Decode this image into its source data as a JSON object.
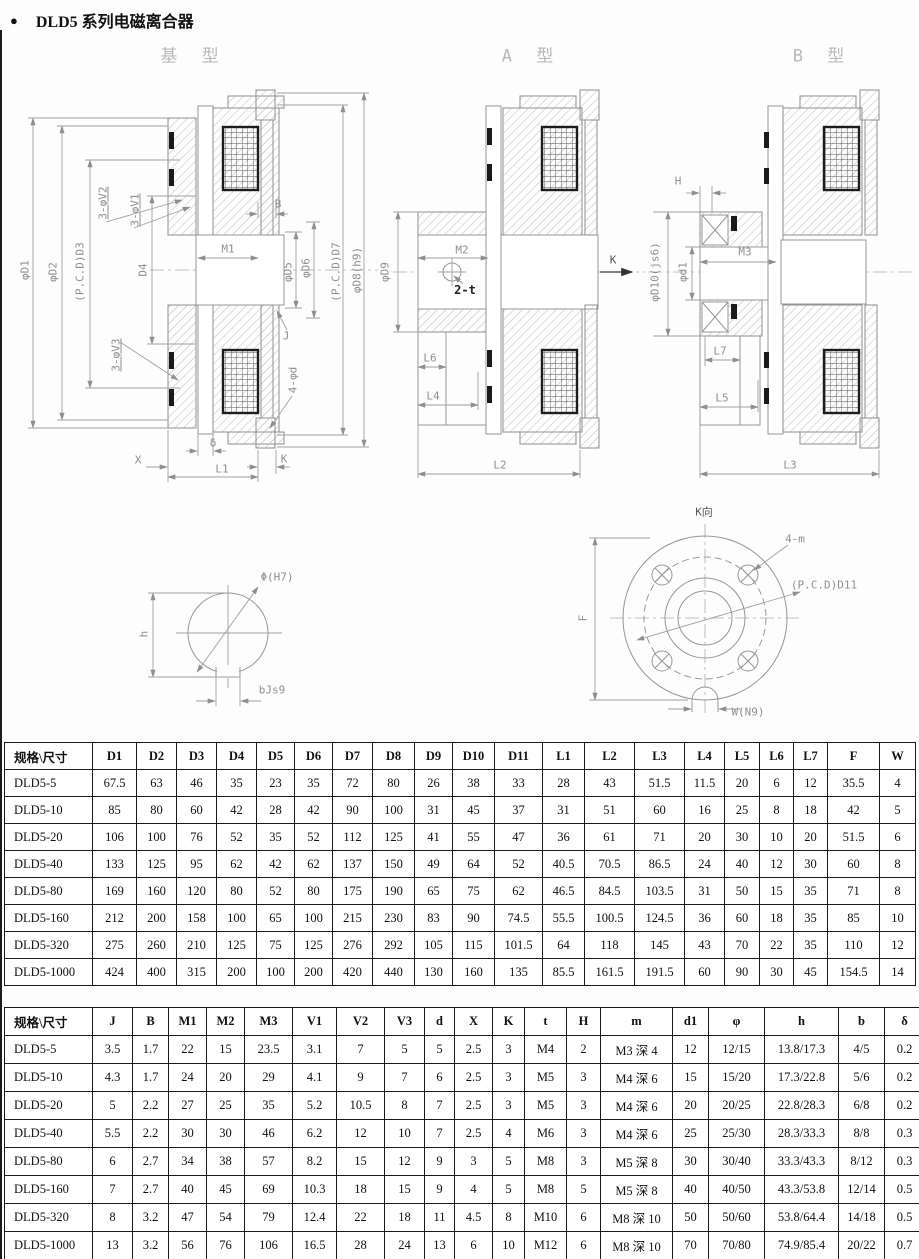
{
  "page": {
    "bullet": "●",
    "title": "DLD5 系列电磁离合器"
  },
  "drawings": {
    "labels": [
      {
        "n": "base-type-title",
        "t": "基 型",
        "x": 193,
        "y": 57,
        "cls": "title"
      },
      {
        "n": "a-type-title",
        "t": "A 型",
        "x": 531,
        "y": 57,
        "cls": "title"
      },
      {
        "n": "b-type-title",
        "t": "B 型",
        "x": 822,
        "y": 57,
        "cls": "title"
      },
      {
        "n": "dim-phi-d1",
        "t": "φD1",
        "x": 25,
        "y": 270,
        "r": -90
      },
      {
        "n": "dim-phi-d2",
        "t": "φD2",
        "x": 53,
        "y": 272,
        "r": -90
      },
      {
        "n": "dim-pcd-d3",
        "t": "(P.C.D)D3",
        "x": 80,
        "y": 272,
        "r": -90
      },
      {
        "n": "dim-3-phi-v2",
        "t": "3-φV2",
        "x": 103,
        "y": 203,
        "r": -90,
        "cls": "und"
      },
      {
        "n": "dim-3-phi-v1",
        "t": "3-φV1",
        "x": 135,
        "y": 210,
        "r": -90,
        "cls": "und"
      },
      {
        "n": "dim-d4",
        "t": "D4",
        "x": 143,
        "y": 270,
        "r": -90
      },
      {
        "n": "dim-3-phi-v3",
        "t": "3-φV3",
        "x": 116,
        "y": 355,
        "r": -90,
        "cls": "und"
      },
      {
        "n": "dim-m1",
        "t": "M1",
        "x": 228,
        "y": 249
      },
      {
        "n": "dim-b",
        "t": "B",
        "x": 278,
        "y": 204
      },
      {
        "n": "dim-phi-d5",
        "t": "φD5",
        "x": 288,
        "y": 272,
        "r": -90
      },
      {
        "n": "dim-phi-d6",
        "t": "φD6",
        "x": 306,
        "y": 268,
        "r": -90
      },
      {
        "n": "dim-pcd-d7",
        "t": "(P.C.D)D7",
        "x": 336,
        "y": 272,
        "r": -90
      },
      {
        "n": "dim-phi-d8",
        "t": "φD8(h9)",
        "x": 357,
        "y": 270,
        "r": -90
      },
      {
        "n": "dim-j",
        "t": "J",
        "x": 286,
        "y": 336
      },
      {
        "n": "dim-4-phi-d",
        "t": "4-φd",
        "x": 293,
        "y": 380,
        "r": -90
      },
      {
        "n": "dim-delta",
        "t": "δ",
        "x": 213,
        "y": 443
      },
      {
        "n": "dim-x",
        "t": "X",
        "x": 138,
        "y": 460
      },
      {
        "n": "dim-l1",
        "t": "L1",
        "x": 222,
        "y": 469
      },
      {
        "n": "dim-k1",
        "t": "K",
        "x": 284,
        "y": 459
      },
      {
        "n": "dim-phi-d9",
        "t": "φD9",
        "x": 385,
        "y": 272,
        "r": -90
      },
      {
        "n": "dim-m2",
        "t": "M2",
        "x": 462,
        "y": 250
      },
      {
        "n": "dim-2-t",
        "t": "2-t",
        "x": 465,
        "y": 290,
        "cls": "dark"
      },
      {
        "n": "dim-l6",
        "t": "L6",
        "x": 430,
        "y": 358
      },
      {
        "n": "dim-l4",
        "t": "L4",
        "x": 433,
        "y": 396
      },
      {
        "n": "dim-l2",
        "t": "L2",
        "x": 500,
        "y": 465
      },
      {
        "n": "dim-k2",
        "t": "K",
        "x": 613,
        "y": 260,
        "cls": "semi"
      },
      {
        "n": "dim-h-gap",
        "t": "H",
        "x": 678,
        "y": 181
      },
      {
        "n": "dim-phi-d10",
        "t": "φD10(js6)",
        "x": 655,
        "y": 272,
        "r": -90
      },
      {
        "n": "dim-phi-d1-small",
        "t": "φd1",
        "x": 683,
        "y": 272,
        "r": -90
      },
      {
        "n": "dim-m3",
        "t": "M3",
        "x": 745,
        "y": 252
      },
      {
        "n": "dim-l7",
        "t": "L7",
        "x": 720,
        "y": 351
      },
      {
        "n": "dim-l5",
        "t": "L5",
        "x": 722,
        "y": 398
      },
      {
        "n": "dim-l3",
        "t": "L3",
        "x": 790,
        "y": 465
      },
      {
        "n": "dim-phi-h7",
        "t": "Φ(H7)",
        "x": 277,
        "y": 577
      },
      {
        "n": "dim-h-bore",
        "t": "h",
        "x": 144,
        "y": 634,
        "r": -90
      },
      {
        "n": "dim-b-js9",
        "t": "bJs9",
        "x": 272,
        "y": 690
      },
      {
        "n": "k-view-title",
        "t": "K向",
        "x": 704,
        "y": 512,
        "cls": "semi"
      },
      {
        "n": "dim-4-m",
        "t": "4-m",
        "x": 795,
        "y": 539
      },
      {
        "n": "dim-pcd-d11",
        "t": "(P.C.D)D11",
        "x": 824,
        "y": 585
      },
      {
        "n": "dim-f",
        "t": "F",
        "x": 583,
        "y": 618,
        "r": -90
      },
      {
        "n": "dim-w-n9",
        "t": "W(N9)",
        "x": 748,
        "y": 712
      }
    ]
  },
  "tables": [
    {
      "name": "dimensions-table-1",
      "headers": [
        "规格\\尺寸",
        "D1",
        "D2",
        "D3",
        "D4",
        "D5",
        "D6",
        "D7",
        "D8",
        "D9",
        "D10",
        "D11",
        "L1",
        "L2",
        "L3",
        "L4",
        "L5",
        "L6",
        "L7",
        "F",
        "W"
      ],
      "rows": [
        [
          "DLD5-5",
          "67.5",
          "63",
          "46",
          "35",
          "23",
          "35",
          "72",
          "80",
          "26",
          "38",
          "33",
          "28",
          "43",
          "51.5",
          "11.5",
          "20",
          "6",
          "12",
          "35.5",
          "4"
        ],
        [
          "DLD5-10",
          "85",
          "80",
          "60",
          "42",
          "28",
          "42",
          "90",
          "100",
          "31",
          "45",
          "37",
          "31",
          "51",
          "60",
          "16",
          "25",
          "8",
          "18",
          "42",
          "5"
        ],
        [
          "DLD5-20",
          "106",
          "100",
          "76",
          "52",
          "35",
          "52",
          "112",
          "125",
          "41",
          "55",
          "47",
          "36",
          "61",
          "71",
          "20",
          "30",
          "10",
          "20",
          "51.5",
          "6"
        ],
        [
          "DLD5-40",
          "133",
          "125",
          "95",
          "62",
          "42",
          "62",
          "137",
          "150",
          "49",
          "64",
          "52",
          "40.5",
          "70.5",
          "86.5",
          "24",
          "40",
          "12",
          "30",
          "60",
          "8"
        ],
        [
          "DLD5-80",
          "169",
          "160",
          "120",
          "80",
          "52",
          "80",
          "175",
          "190",
          "65",
          "75",
          "62",
          "46.5",
          "84.5",
          "103.5",
          "31",
          "50",
          "15",
          "35",
          "71",
          "8"
        ],
        [
          "DLD5-160",
          "212",
          "200",
          "158",
          "100",
          "65",
          "100",
          "215",
          "230",
          "83",
          "90",
          "74.5",
          "55.5",
          "100.5",
          "124.5",
          "36",
          "60",
          "18",
          "35",
          "85",
          "10"
        ],
        [
          "DLD5-320",
          "275",
          "260",
          "210",
          "125",
          "75",
          "125",
          "276",
          "292",
          "105",
          "115",
          "101.5",
          "64",
          "118",
          "145",
          "43",
          "70",
          "22",
          "35",
          "110",
          "12"
        ],
        [
          "DLD5-1000",
          "424",
          "400",
          "315",
          "200",
          "100",
          "200",
          "420",
          "440",
          "130",
          "160",
          "135",
          "85.5",
          "161.5",
          "191.5",
          "60",
          "90",
          "30",
          "45",
          "154.5",
          "14"
        ]
      ]
    },
    {
      "name": "dimensions-table-2",
      "headers": [
        "规格\\尺寸",
        "J",
        "B",
        "M1",
        "M2",
        "M3",
        "V1",
        "V2",
        "V3",
        "d",
        "X",
        "K",
        "t",
        "H",
        "m",
        "d1",
        "φ",
        "h",
        "b",
        "δ"
      ],
      "rows": [
        [
          "DLD5-5",
          "3.5",
          "1.7",
          "22",
          "15",
          "23.5",
          "3.1",
          "7",
          "5",
          "5",
          "2.5",
          "3",
          "M4",
          "2",
          "M3 深 4",
          "12",
          "12/15",
          "13.8/17.3",
          "4/5",
          "0.2"
        ],
        [
          "DLD5-10",
          "4.3",
          "1.7",
          "24",
          "20",
          "29",
          "4.1",
          "9",
          "7",
          "6",
          "2.5",
          "3",
          "M5",
          "3",
          "M4 深 6",
          "15",
          "15/20",
          "17.3/22.8",
          "5/6",
          "0.2"
        ],
        [
          "DLD5-20",
          "5",
          "2.2",
          "27",
          "25",
          "35",
          "5.2",
          "10.5",
          "8",
          "7",
          "2.5",
          "3",
          "M5",
          "3",
          "M4 深 6",
          "20",
          "20/25",
          "22.8/28.3",
          "6/8",
          "0.2"
        ],
        [
          "DLD5-40",
          "5.5",
          "2.2",
          "30",
          "30",
          "46",
          "6.2",
          "12",
          "10",
          "7",
          "2.5",
          "4",
          "M6",
          "3",
          "M4 深 6",
          "25",
          "25/30",
          "28.3/33.3",
          "8/8",
          "0.3"
        ],
        [
          "DLD5-80",
          "6",
          "2.7",
          "34",
          "38",
          "57",
          "8.2",
          "15",
          "12",
          "9",
          "3",
          "5",
          "M8",
          "3",
          "M5 深 8",
          "30",
          "30/40",
          "33.3/43.3",
          "8/12",
          "0.3"
        ],
        [
          "DLD5-160",
          "7",
          "2.7",
          "40",
          "45",
          "69",
          "10.3",
          "18",
          "15",
          "9",
          "4",
          "5",
          "M8",
          "5",
          "M5 深 8",
          "40",
          "40/50",
          "43.3/53.8",
          "12/14",
          "0.5"
        ],
        [
          "DLD5-320",
          "8",
          "3.2",
          "47",
          "54",
          "79",
          "12.4",
          "22",
          "18",
          "11",
          "4.5",
          "8",
          "M10",
          "6",
          "M8 深 10",
          "50",
          "50/60",
          "53.8/64.4",
          "14/18",
          "0.5"
        ],
        [
          "DLD5-1000",
          "13",
          "3.2",
          "56",
          "76",
          "106",
          "16.5",
          "28",
          "24",
          "13",
          "6",
          "10",
          "M12",
          "6",
          "M8 深 10",
          "70",
          "70/80",
          "74.9/85.4",
          "20/22",
          "0.7"
        ]
      ]
    }
  ]
}
